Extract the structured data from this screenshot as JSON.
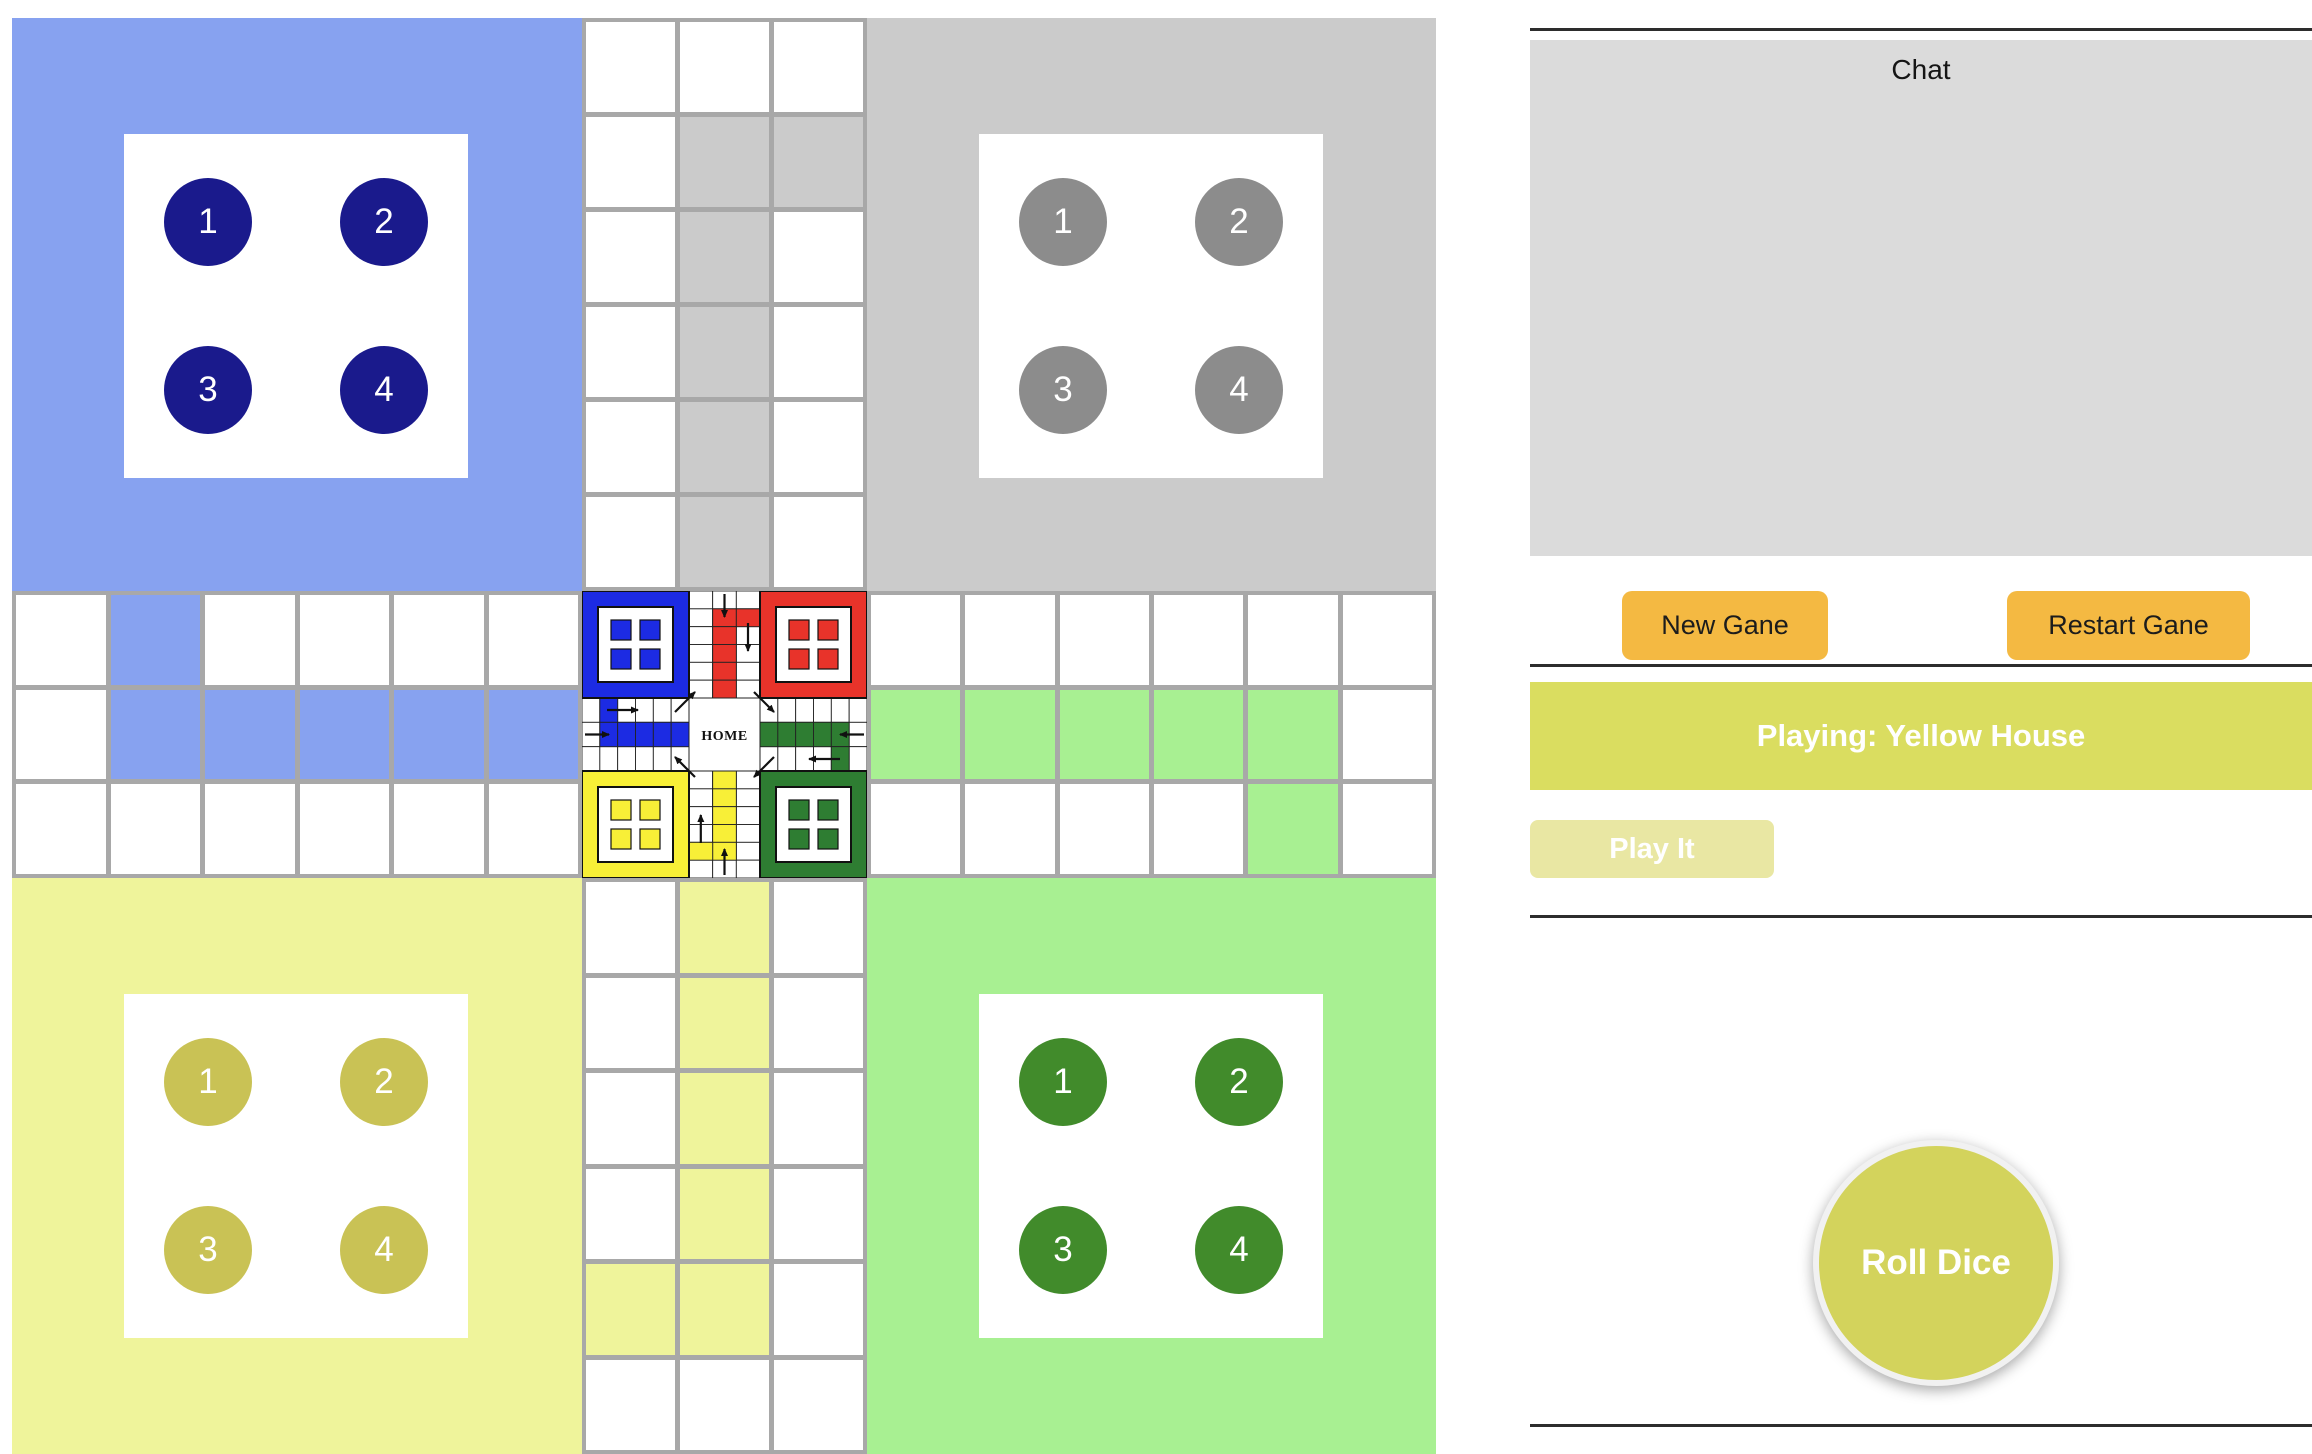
{
  "board": {
    "quadrants": [
      {
        "name": "blue",
        "bg": "#87A2F0",
        "piece_bg": "#1A1A8C",
        "pieces": [
          "1",
          "2",
          "3",
          "4"
        ]
      },
      {
        "name": "gray",
        "bg": "#CBCBCB",
        "piece_bg": "#8C8C8C",
        "pieces": [
          "1",
          "2",
          "3",
          "4"
        ]
      },
      {
        "name": "yellow",
        "bg": "#EFF49B",
        "piece_bg": "#C9C255",
        "pieces": [
          "1",
          "2",
          "3",
          "4"
        ]
      },
      {
        "name": "green",
        "bg": "#A8F092",
        "piece_bg": "#418B2B",
        "pieces": [
          "1",
          "2",
          "3",
          "4"
        ]
      }
    ],
    "strips": {
      "top": {
        "cols": 3,
        "rows": 6,
        "cell_color": "#CBCBCB",
        "colored_cells": [
          [
            2,
            2
          ],
          [
            3,
            2
          ],
          [
            2,
            3
          ],
          [
            2,
            4
          ],
          [
            2,
            5
          ],
          [
            2,
            6
          ]
        ]
      },
      "left": {
        "cols": 6,
        "rows": 3,
        "cell_color": "#87A2F0",
        "colored_cells": [
          [
            2,
            1
          ],
          [
            2,
            2
          ],
          [
            3,
            2
          ],
          [
            4,
            2
          ],
          [
            5,
            2
          ],
          [
            6,
            2
          ]
        ]
      },
      "right": {
        "cols": 6,
        "rows": 3,
        "cell_color": "#A8F092",
        "colored_cells": [
          [
            1,
            2
          ],
          [
            2,
            2
          ],
          [
            3,
            2
          ],
          [
            4,
            2
          ],
          [
            5,
            2
          ],
          [
            5,
            3
          ]
        ]
      },
      "bottom": {
        "cols": 3,
        "rows": 6,
        "cell_color": "#EFF49B",
        "colored_cells": [
          [
            2,
            1
          ],
          [
            2,
            2
          ],
          [
            2,
            3
          ],
          [
            2,
            4
          ],
          [
            2,
            5
          ],
          [
            1,
            5
          ]
        ]
      }
    },
    "center": {
      "label": "HOME",
      "corner_colors": {
        "tl": "#1C2BE3",
        "tr": "#E8332A",
        "bl": "#F8EF37",
        "br": "#2E7D32"
      },
      "arm_colors": {
        "top": "#E8332A",
        "left": "#1C2BE3",
        "right": "#2E7D32",
        "bottom": "#F8EF37"
      }
    }
  },
  "panel": {
    "chat_title": "Chat",
    "new_game_label": "New Gane",
    "restart_game_label": "Restart Gane",
    "status_text": "Playing: Yellow House",
    "play_it_label": "Play It",
    "roll_dice_label": "Roll Dice",
    "accent_orange": "#F4B942",
    "banner_color": "#DADD60",
    "roll_dice_color": "#D3D35C"
  }
}
